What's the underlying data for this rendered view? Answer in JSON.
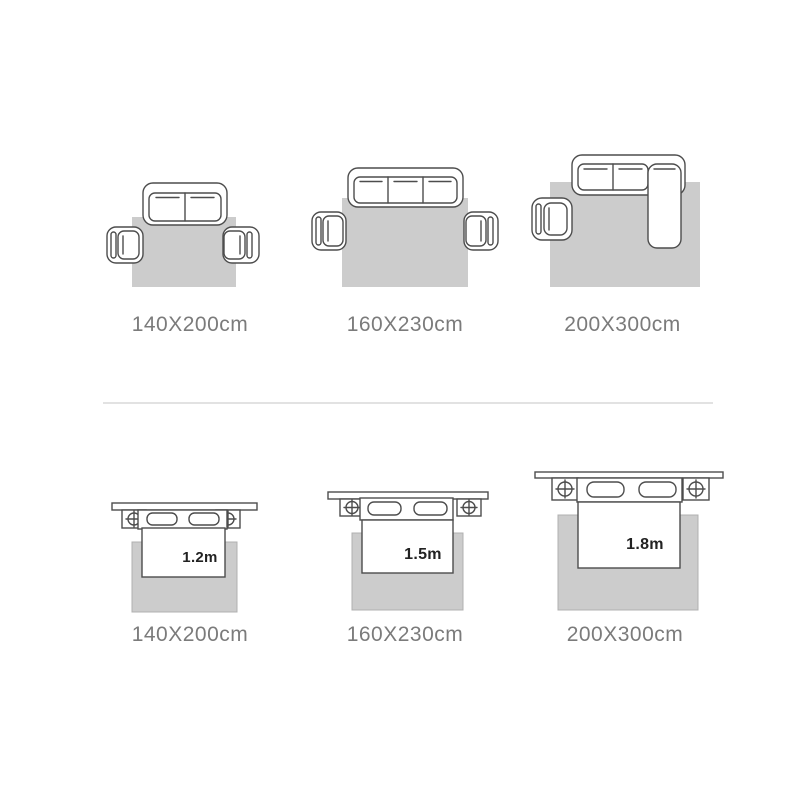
{
  "page": {
    "background": "#ffffff"
  },
  "colors": {
    "furniture_outline": "#4d4d4d",
    "furniture_fill": "#ffffff",
    "rug_fill": "#cccccc",
    "rug_stroke": "#b0b0b0",
    "size_label_text": "#7b7b7b",
    "bed_width_text": "#222222",
    "divider": "#e2e2e2"
  },
  "sofa_row": {
    "items": [
      {
        "icon": "loveseat-two-armchairs-rug-diagram",
        "size_label": "140X200cm"
      },
      {
        "icon": "three-seat-sofa-two-armchairs-rug-diagram",
        "size_label": "160X230cm"
      },
      {
        "icon": "sectional-sofa-armchair-rug-diagram",
        "size_label": "200X300cm"
      }
    ]
  },
  "bed_row": {
    "items": [
      {
        "icon": "bed-nightstands-rug-diagram",
        "bed_width_label": "1.2m",
        "size_label": "140X200cm"
      },
      {
        "icon": "bed-nightstands-rug-diagram",
        "bed_width_label": "1.5m",
        "size_label": "160X230cm"
      },
      {
        "icon": "bed-nightstands-rug-diagram",
        "bed_width_label": "1.8m",
        "size_label": "200X300cm"
      }
    ]
  }
}
